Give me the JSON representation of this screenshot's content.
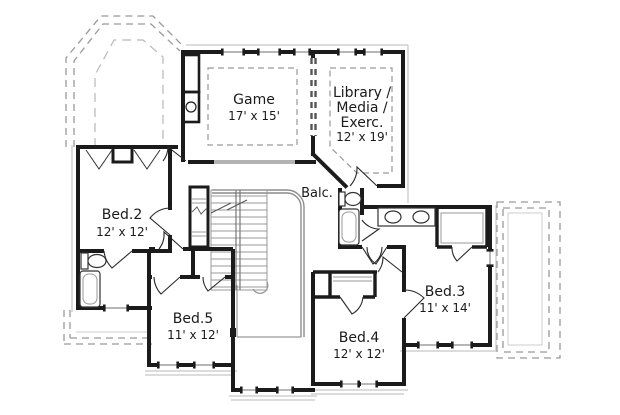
{
  "rooms": {
    "game": {
      "name": "Game",
      "dims": "17' x 15'"
    },
    "library": {
      "name_line1": "Library /",
      "name_line2": "Media /",
      "name_line3": "Exerc.",
      "dims": "12' x 19'"
    },
    "bed2": {
      "name": "Bed.2",
      "dims": "12' x 12'"
    },
    "bed3": {
      "name": "Bed.3",
      "dims": "11' x 14'"
    },
    "bed4": {
      "name": "Bed.4",
      "dims": "12' x 12'"
    },
    "bed5": {
      "name": "Bed.5",
      "dims": "11' x 12'"
    },
    "balcony": {
      "name": "Balc."
    }
  },
  "colors": {
    "walls": "#1b1b1b",
    "thin_lines": "#999999",
    "dashed_roof": "#9a9a9a",
    "railing": "#8c8c8c",
    "background": "#ffffff",
    "text": "#1b1b1b"
  }
}
